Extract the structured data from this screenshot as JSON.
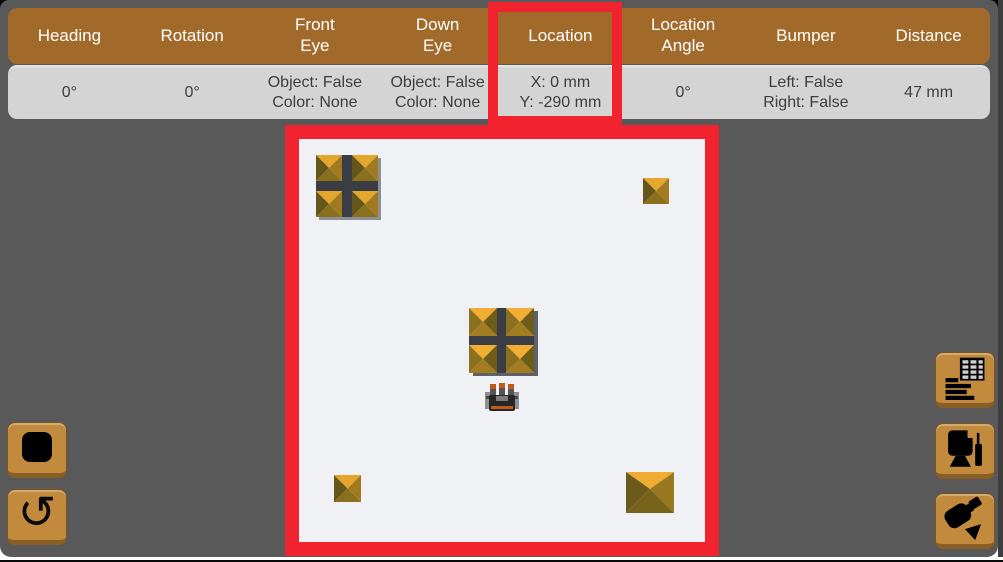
{
  "app": {
    "name": "robot-simulator",
    "colors": {
      "background": "#595959",
      "header_brown": "#A16A2B",
      "value_row_gray": "#D4D4D4",
      "annotation_red": "#F1232E",
      "button_tan": "#C28A3C",
      "field_surface": "#EFF1F4",
      "pyramid_gold": "#E5A62C",
      "pyramid_dark_face": "#65561B",
      "cross_platform_dark": "#3A3E44"
    }
  },
  "sensor_table": {
    "columns": [
      {
        "id": "heading",
        "label": "Heading",
        "value": "0°"
      },
      {
        "id": "rotation",
        "label": "Rotation",
        "value": "0°"
      },
      {
        "id": "front_eye",
        "label": "Front\nEye",
        "value": "Object: False\nColor: None"
      },
      {
        "id": "down_eye",
        "label": "Down\nEye",
        "value": "Object: False\nColor: None"
      },
      {
        "id": "location",
        "label": "Location",
        "value": "X: 0 mm\nY: -290 mm",
        "highlighted": true
      },
      {
        "id": "location_angle",
        "label": "Location\nAngle",
        "value": "0°"
      },
      {
        "id": "bumper",
        "label": "Bumper",
        "value": "Left: False\nRight: False"
      },
      {
        "id": "distance",
        "label": "Distance",
        "value": "47 mm"
      }
    ]
  },
  "annotations": {
    "highlighted_column": "Location",
    "highlight_color": "#F1232E",
    "field_outline_color": "#F1232E"
  },
  "controls": {
    "left": [
      {
        "name": "stop-button",
        "icon": "stop-icon"
      },
      {
        "name": "reset-button",
        "icon": "reset-icon"
      }
    ],
    "right": [
      {
        "name": "data-table-button",
        "icon": "data-table-icon"
      },
      {
        "name": "monitor-button",
        "icon": "monitor-icon"
      },
      {
        "name": "camera-button",
        "icon": "camera-icon"
      }
    ],
    "icons": {
      "reset_glyph": "↺"
    }
  },
  "field": {
    "objects": [
      {
        "type": "pyramid-cluster-2x2",
        "position": "top-left"
      },
      {
        "type": "pyramid-small",
        "position": "top-right"
      },
      {
        "type": "pyramid-cluster-2x2",
        "position": "center"
      },
      {
        "type": "robot",
        "position": "center-south"
      },
      {
        "type": "pyramid-small",
        "position": "bottom-left"
      },
      {
        "type": "pyramid-large",
        "position": "bottom-right"
      }
    ]
  }
}
